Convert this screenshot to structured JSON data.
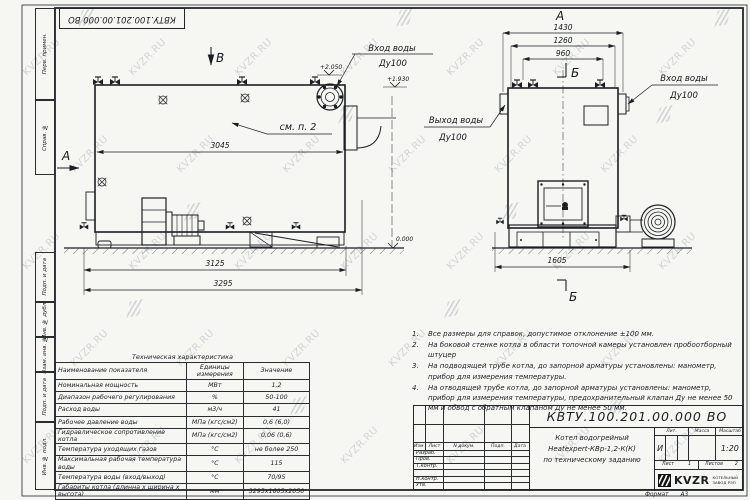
{
  "watermark": {
    "text": "KVZR.RU"
  },
  "corner_stamp": "КВТУ.100.201.00.000 ВО",
  "margin_labels": [
    "Перв. примен.",
    "Справ. №",
    "Подп. и дата",
    "Инв. № дубл.",
    "Взам. инв. №",
    "Подп. и дата",
    "Инв. № подл."
  ],
  "drawing": {
    "left_view": {
      "view_label": "В",
      "section_label": "А",
      "callout": "см. п. 2",
      "dim_inner": "3045",
      "dim_mid": "3125",
      "dim_outer": "3295",
      "elev_top": "+2.050",
      "elev_mid": "+1.930",
      "elev_zero": "0.000",
      "inlet_label": "Вход воды",
      "inlet_dn": "Ду100"
    },
    "right_view": {
      "view_label": "А",
      "section_label_top": "Б",
      "section_label_bottom": "Б",
      "dim1": "1430",
      "dim2": "1260",
      "dim3": "960",
      "dim_base": "1605",
      "outlet_label": "Выход воды",
      "outlet_dn": "Ду100",
      "inlet_label": "Вход воды",
      "inlet_dn": "Ду100"
    }
  },
  "notes": [
    {
      "num": "1.",
      "text": "Все размеры для справок, допустимое отклонение  ±100 мм."
    },
    {
      "num": "2.",
      "text": "На боковой стенке котла в области топочной камеры установлен пробоотборный штуцер"
    },
    {
      "num": "3.",
      "text": "На  подводящей трубе котла, до запорной арматуры установлены: манометр, прибор для измерения температуры."
    },
    {
      "num": "4.",
      "text": "На отводящей трубе котла, до запорной арматуры установлены: манометр, прибор для измерения температуры, предохранительный клапан Ду не менее 50 мм и обвод с обратным клапаном Ду не менее 50 мм."
    }
  ],
  "spec_table": {
    "title": "Техническая характеристика",
    "headers": [
      "Наименование показателя",
      "Единицы измерения",
      "Значение"
    ],
    "rows": [
      [
        "Номинальная мощность",
        "МВт",
        "1,2"
      ],
      [
        "Диапазон рабочего регулирования",
        "%",
        "50-100"
      ],
      [
        "Расход воды",
        "м3/ч",
        "41"
      ],
      [
        "Рабочее давление воды",
        "МПа (кгс/см2)",
        "0,6 (6,0)"
      ],
      [
        "Гидравлическое сопротивление котла",
        "МПа (кгс/см2)",
        "0,06 (0,6)"
      ],
      [
        "Температура уходящих газов",
        "°С",
        "не более 250"
      ],
      [
        "Максимальная рабочая температура воды",
        "°С",
        "115"
      ],
      [
        "Температура воды (вход/выход)",
        "°С",
        "70/95"
      ],
      [
        "Габариты котла (длинна х ширина х высота)",
        "мм",
        "3295х1605х2050"
      ]
    ]
  },
  "title_block": {
    "doc_number": "КВТУ.100.201.00.000 ВО",
    "header_cols": [
      "Изм.",
      "Лист",
      "N докум.",
      "Подп.",
      "Дата"
    ],
    "row_labels": [
      "Разраб.",
      "Пров.",
      "Т.контр.",
      "",
      "Н.контр.",
      "Утв."
    ],
    "title_lines": [
      "Котел водогрейный",
      "Heatexpert-КВр-1,2-К(К)",
      "по техническому заданию"
    ],
    "lit_header": [
      "Лит.",
      "Масса",
      "Масштаб"
    ],
    "lit_value": "И",
    "scale": "1:20",
    "sheet_label": "Лист",
    "sheet_num": "1",
    "sheets_label": "Листов",
    "sheets_num": "2",
    "logo_text": "KVZR",
    "logo_caption_1": "КОТЕЛЬНЫЙ",
    "logo_caption_2": "ЗАВОД РЭП",
    "format_label": "Формат",
    "format_value": "А3"
  }
}
